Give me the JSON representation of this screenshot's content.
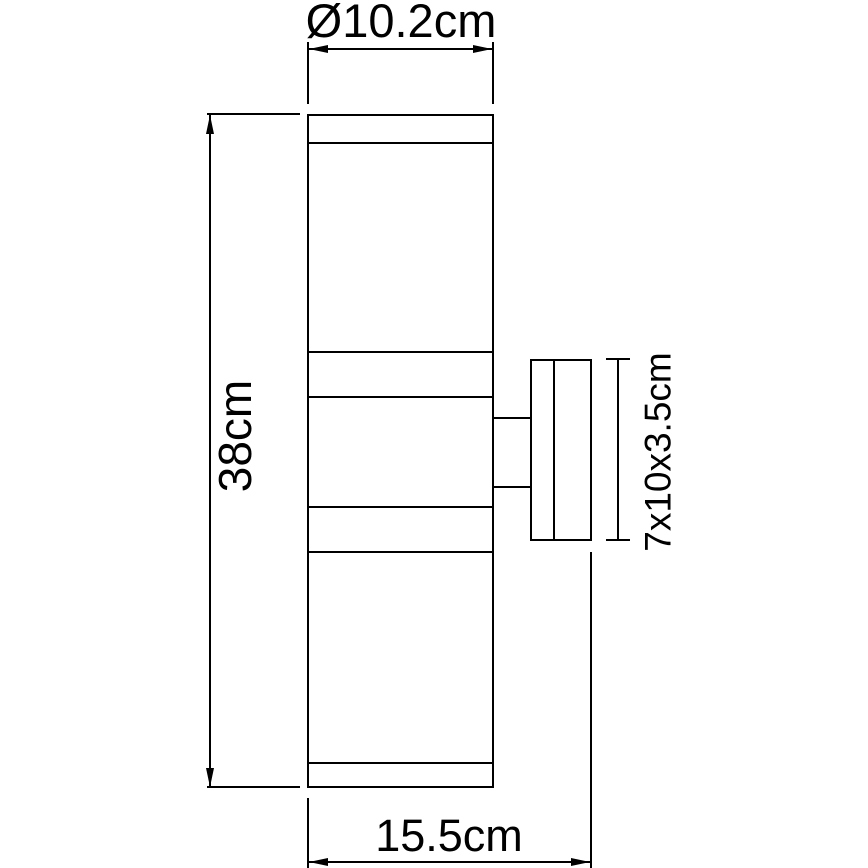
{
  "drawing": {
    "labels": {
      "diameter": "Ø10.2cm",
      "height": "38cm",
      "bracket": "7x10x3.5cm",
      "depth": "15.5cm"
    },
    "colors": {
      "line": "#000000",
      "text": "#000000",
      "background": "#ffffff"
    }
  }
}
